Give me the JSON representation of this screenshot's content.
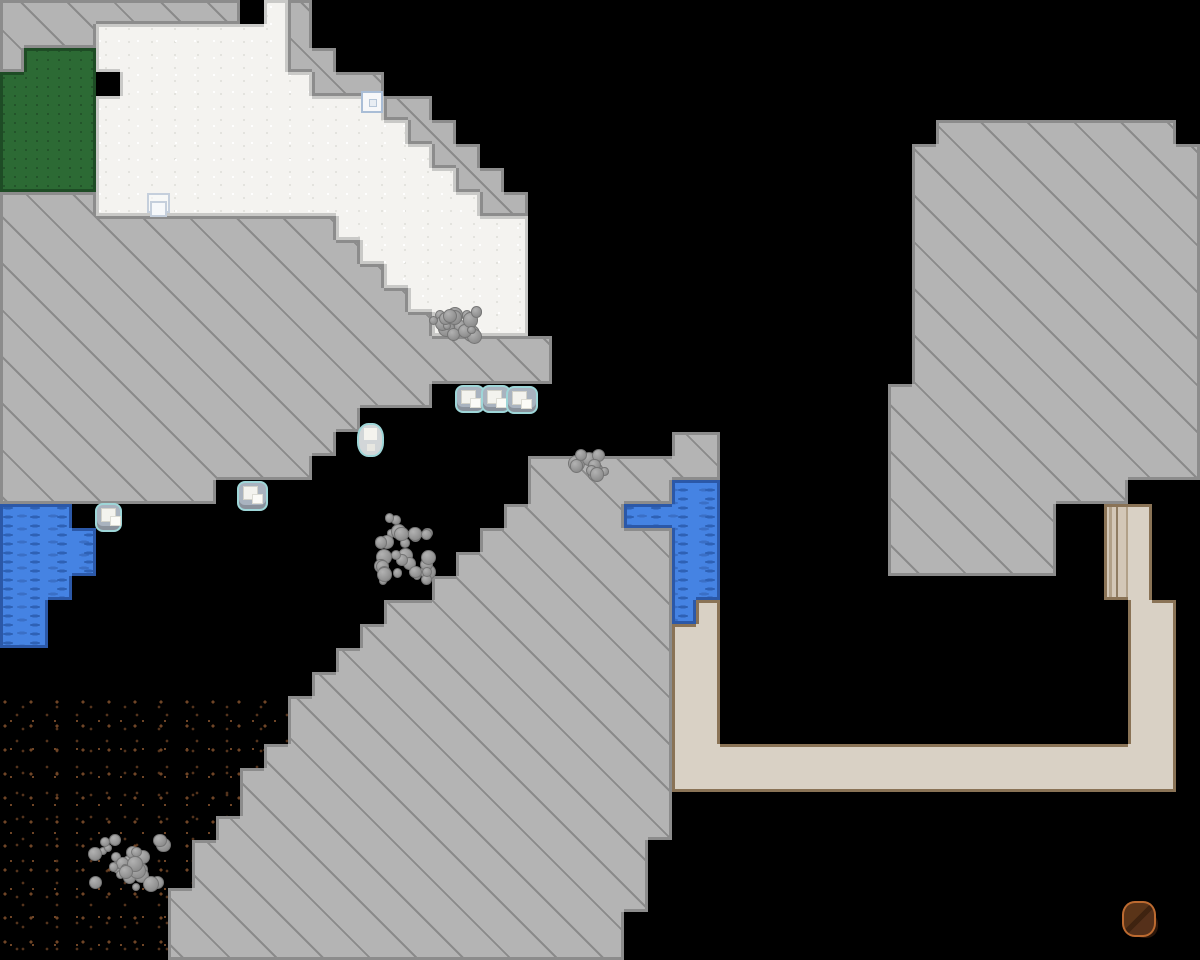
{
  "meta": {
    "app": "fortress-map-view",
    "description": "Top-down tile map of a fortress site: hatched revealed rock, snow field, grass patch, two water bodies, speckled soil cavern floor, constructed tan floor corridor with bridge, item icons, boulder piles and one creature. No text/HUD visible."
  },
  "map": {
    "tile_px": 24,
    "cols": 50,
    "rows_count": 40,
    "legend": {
      "K": "void",
      "R": "rock",
      "S": "snow",
      "G": "grass",
      "W": "water",
      "D": "soil",
      "T": "floor",
      "B": "bridge"
    },
    "colors": {
      "void": "#000000",
      "rock": "#b4b4b4",
      "rock_line": "rgba(70,70,70,0.38)",
      "rock_edge": "#8c8c8c",
      "snow": "#f4f3f0",
      "snow_edge": "#c9c9c7",
      "grass": "#2c6a34",
      "grass_edge": "#1e4c25",
      "water": "#4583e3",
      "water_dash": "#2e61b5",
      "water_dash2": "#3a6fc6",
      "water_edge": "#2b58a8",
      "soil_dot1": "#6f4526",
      "soil_dot2": "#54331c",
      "floor": "#d9d1c5",
      "floor_edge": "#8a7356",
      "bridge_a": "#d3c7b7",
      "bridge_b": "#b1a088",
      "bridge_c": "#8f7c62"
    },
    "rows": [
      "RRRRRRRRRRKSRKKKKKKKKKKKKKKKKKKKKKKKKKKKKKKKKKKKKK",
      "RRRRSSSSSSSSRKKKKKKKKKKKKKKKKKKKKKKKKKKKKKKKKKKKKK",
      "RGGGSSSSSSSSRRKKKKKKKKKKKKKKKKKKKKKKKKKKKKKKKKKKKK",
      "GGGGKSSSSSSSSRRRKKKKKKKKKKKKKKKKKKKKKKKKKKKKKKKKKK",
      "GGGGSSSSSSSSSSSSRRKKKKKKKKKKKKKKKKKKKKKKKKKKKKKKKK",
      "GGGGSSSSSSSSSSSSSRRKKKKKKKKKKKKKKKKKKKKRRRRRRRRRRK",
      "GGGGSSSSSSSSSSSSSSRRKKKKKKKKKKKKKKKKKKRRRRRRRRRRRR",
      "GGGGSSSSSSSSSSSSSSSRRKKKKKKKKKKKKKKKKKRRRRRRRRRRRR",
      "RRRRSSSSSSSSSSSSSSSSRRKKKKKKKKKKKKKKKKRRRRRRRRRRRR",
      "RRRRRRRRRRRRRRSSSSSSSSKKKKKKKKKKKKKKKKRRRRRRRRRRRR",
      "RRRRRRRRRRRRRRRSSSSSSSKKKKKKKKKKKKKKKKRRRRRRRRRRRR",
      "RRRRRRRRRRRRRRRRSSSSSSKKKKKKKKKKKKKKKKRRRRRRRRRRRR",
      "RRRRRRRRRRRRRRRRRSSSSSKKKKKKKKKKKKKKKKRRRRRRRRRRRR",
      "RRRRRRRRRRRRRRRRRRSSSSKKKKKKKKKKKKKKKKRRRRRRRRRRRR",
      "RRRRRRRRRRRRRRRRRRRRRRRKKKKKKKKKKKKKKKRRRRRRRRRRRR",
      "RRRRRRRRRRRRRRRRRRRRRRRKKKKKKKKKKKKKKKRRRRRRRRRRRR",
      "RRRRRRRRRRRRRRRRRRKKKKKKKKKKKKKKKKKKKRRRRRRRRRRRRR",
      "RRRRRRRRRRRRRRRKKKKKKKKKKKKKKKKKKKKKKRRRRRRRRRRRRR",
      "RRRRRRRRRRRRRRKKKKKKKKKKKKKKRRKKKKKKKRRRRRRRRRRRRR",
      "RRRRRRRRRRRRRKKKKKKKKKRRRRRRRRKKKKKKKRRRRRRRRRRRRR",
      "RRRRRRRRRKKKKKKKKKKKKKRRRRRRWWKKKKKKKRRRRRRRRRRKKK",
      "WWWKKKKKKKKKKKKKKKKKKRRRRRWWWWKKKKKKKRRRRRRRKKBTKK",
      "WWWWKKKKKKKKKKKKKKKKRRRRRRRRWWKKKKKKKRRRRRRRKKBTKK",
      "WWWWKKKKKKKKKKKKKKKRRRRRRRRRWWKKKKKKKRRRRRRRKKBTKK",
      "WWWKKKKKKKKKKKKKKKRRRRRRRRRRWWKKKKKKKKKKKKKKKKBTKK",
      "WWKKKKKKKKKKKKKKRRRRRRRRRRRRWTKKKKKKKKKKKKKKKKKTTK",
      "WWKKKKKKKKKKKKKRRRRRRRRRRRRRTTKKKKKKKKKKKKKKKKKTTK",
      "KKKKKKKKKKKKKKRRRRRRRRRRRRRRTTKKKKKKKKKKKKKKKKKTTK",
      "KKKKKKKKKKKKKRRRRRRRRRRRRRRRTTKKKKKKKKKKKKKKKKKTTK",
      "DDDDDDDDDDDDRRRRRRRRRRRRRRRRTTKKKKKKKKKKKKKKKKKTTK",
      "DDDDDDDDDDDDRRRRRRRRRRRRRRRRTTKKKKKKKKKKKKKKKKKTTK",
      "DDDDDDDDDDDRRRRRRRRRRRRRRRRRTTTTTTTTTTTTTTTTTTTTTK",
      "DDDDDDDDDDRRRRRRRRRRRRRRRRRRTTTTTTTTTTTTTTTTTTTTTK",
      "DDDDDDDDDDRRRRRRRRRRRRRRRRRRKKKKKKKKKKKKKKKKKKKKKK",
      "DDDDDDDDDRRRRRRRRRRRRRRRRRRRKKKKKKKKKKKKKKKKKKKKKK",
      "DDDDDDDDRRRRRRRRRRRRRRRRRRRKKKKKKKKKKKKKKKKKKKKKKK",
      "DDDDDDDDRRRRRRRRRRRRRRRRRRRKKKKKKKKKKKKKKKKKKKKKKK",
      "DDDDDDDRRRRRRRRRRRRRRRRRRRRKKKKKKKKKKKKKKKKKKKKKKK",
      "DDDDDDDRRRRRRRRRRRRRRRRRRRKKKKKKKKKKKKKKKKKKKKKKKK",
      "DDDDDDDRRRRRRRRRRRRRRRRRRRKKKKKKKKKKKKKKKKKKKKKKKK"
    ]
  },
  "items": [
    {
      "name": "ghost-building-icon",
      "type": "ghost-blocks-icon",
      "x": 147,
      "y": 193,
      "w": 32,
      "h": 30
    },
    {
      "name": "map-marker-icon",
      "type": "marker-icon",
      "x": 361,
      "y": 91,
      "w": 22,
      "h": 22
    },
    {
      "name": "ice-blocks-item",
      "type": "block-item",
      "x": 455,
      "y": 385,
      "w": 30,
      "h": 28
    },
    {
      "name": "ice-blocks-item",
      "type": "block-item",
      "x": 481,
      "y": 385,
      "w": 30,
      "h": 28
    },
    {
      "name": "ice-blocks-item",
      "type": "block-item",
      "x": 506,
      "y": 386,
      "w": 32,
      "h": 28
    },
    {
      "name": "stone-pot-item",
      "type": "pot-item",
      "x": 357,
      "y": 423,
      "w": 27,
      "h": 34
    },
    {
      "name": "stone-blocks-item",
      "type": "block-item",
      "x": 237,
      "y": 481,
      "w": 31,
      "h": 30
    },
    {
      "name": "stone-blocks-item",
      "type": "block-item",
      "x": 95,
      "y": 503,
      "w": 27,
      "h": 29
    },
    {
      "name": "boulder-pile",
      "type": "boulder-pile",
      "x": 424,
      "y": 303,
      "w": 60,
      "h": 42,
      "seed": 3
    },
    {
      "name": "boulder-pile",
      "type": "boulder-pile",
      "x": 566,
      "y": 446,
      "w": 44,
      "h": 38,
      "seed": 7
    },
    {
      "name": "boulder-pile",
      "type": "boulder-pile",
      "x": 372,
      "y": 510,
      "w": 72,
      "h": 78,
      "seed": 11
    },
    {
      "name": "boulder-pile",
      "type": "boulder-pile",
      "x": 86,
      "y": 830,
      "w": 90,
      "h": 65,
      "seed": 17
    },
    {
      "name": "brown-creature",
      "type": "creature",
      "x": 1122,
      "y": 901,
      "w": 36,
      "h": 40
    }
  ]
}
